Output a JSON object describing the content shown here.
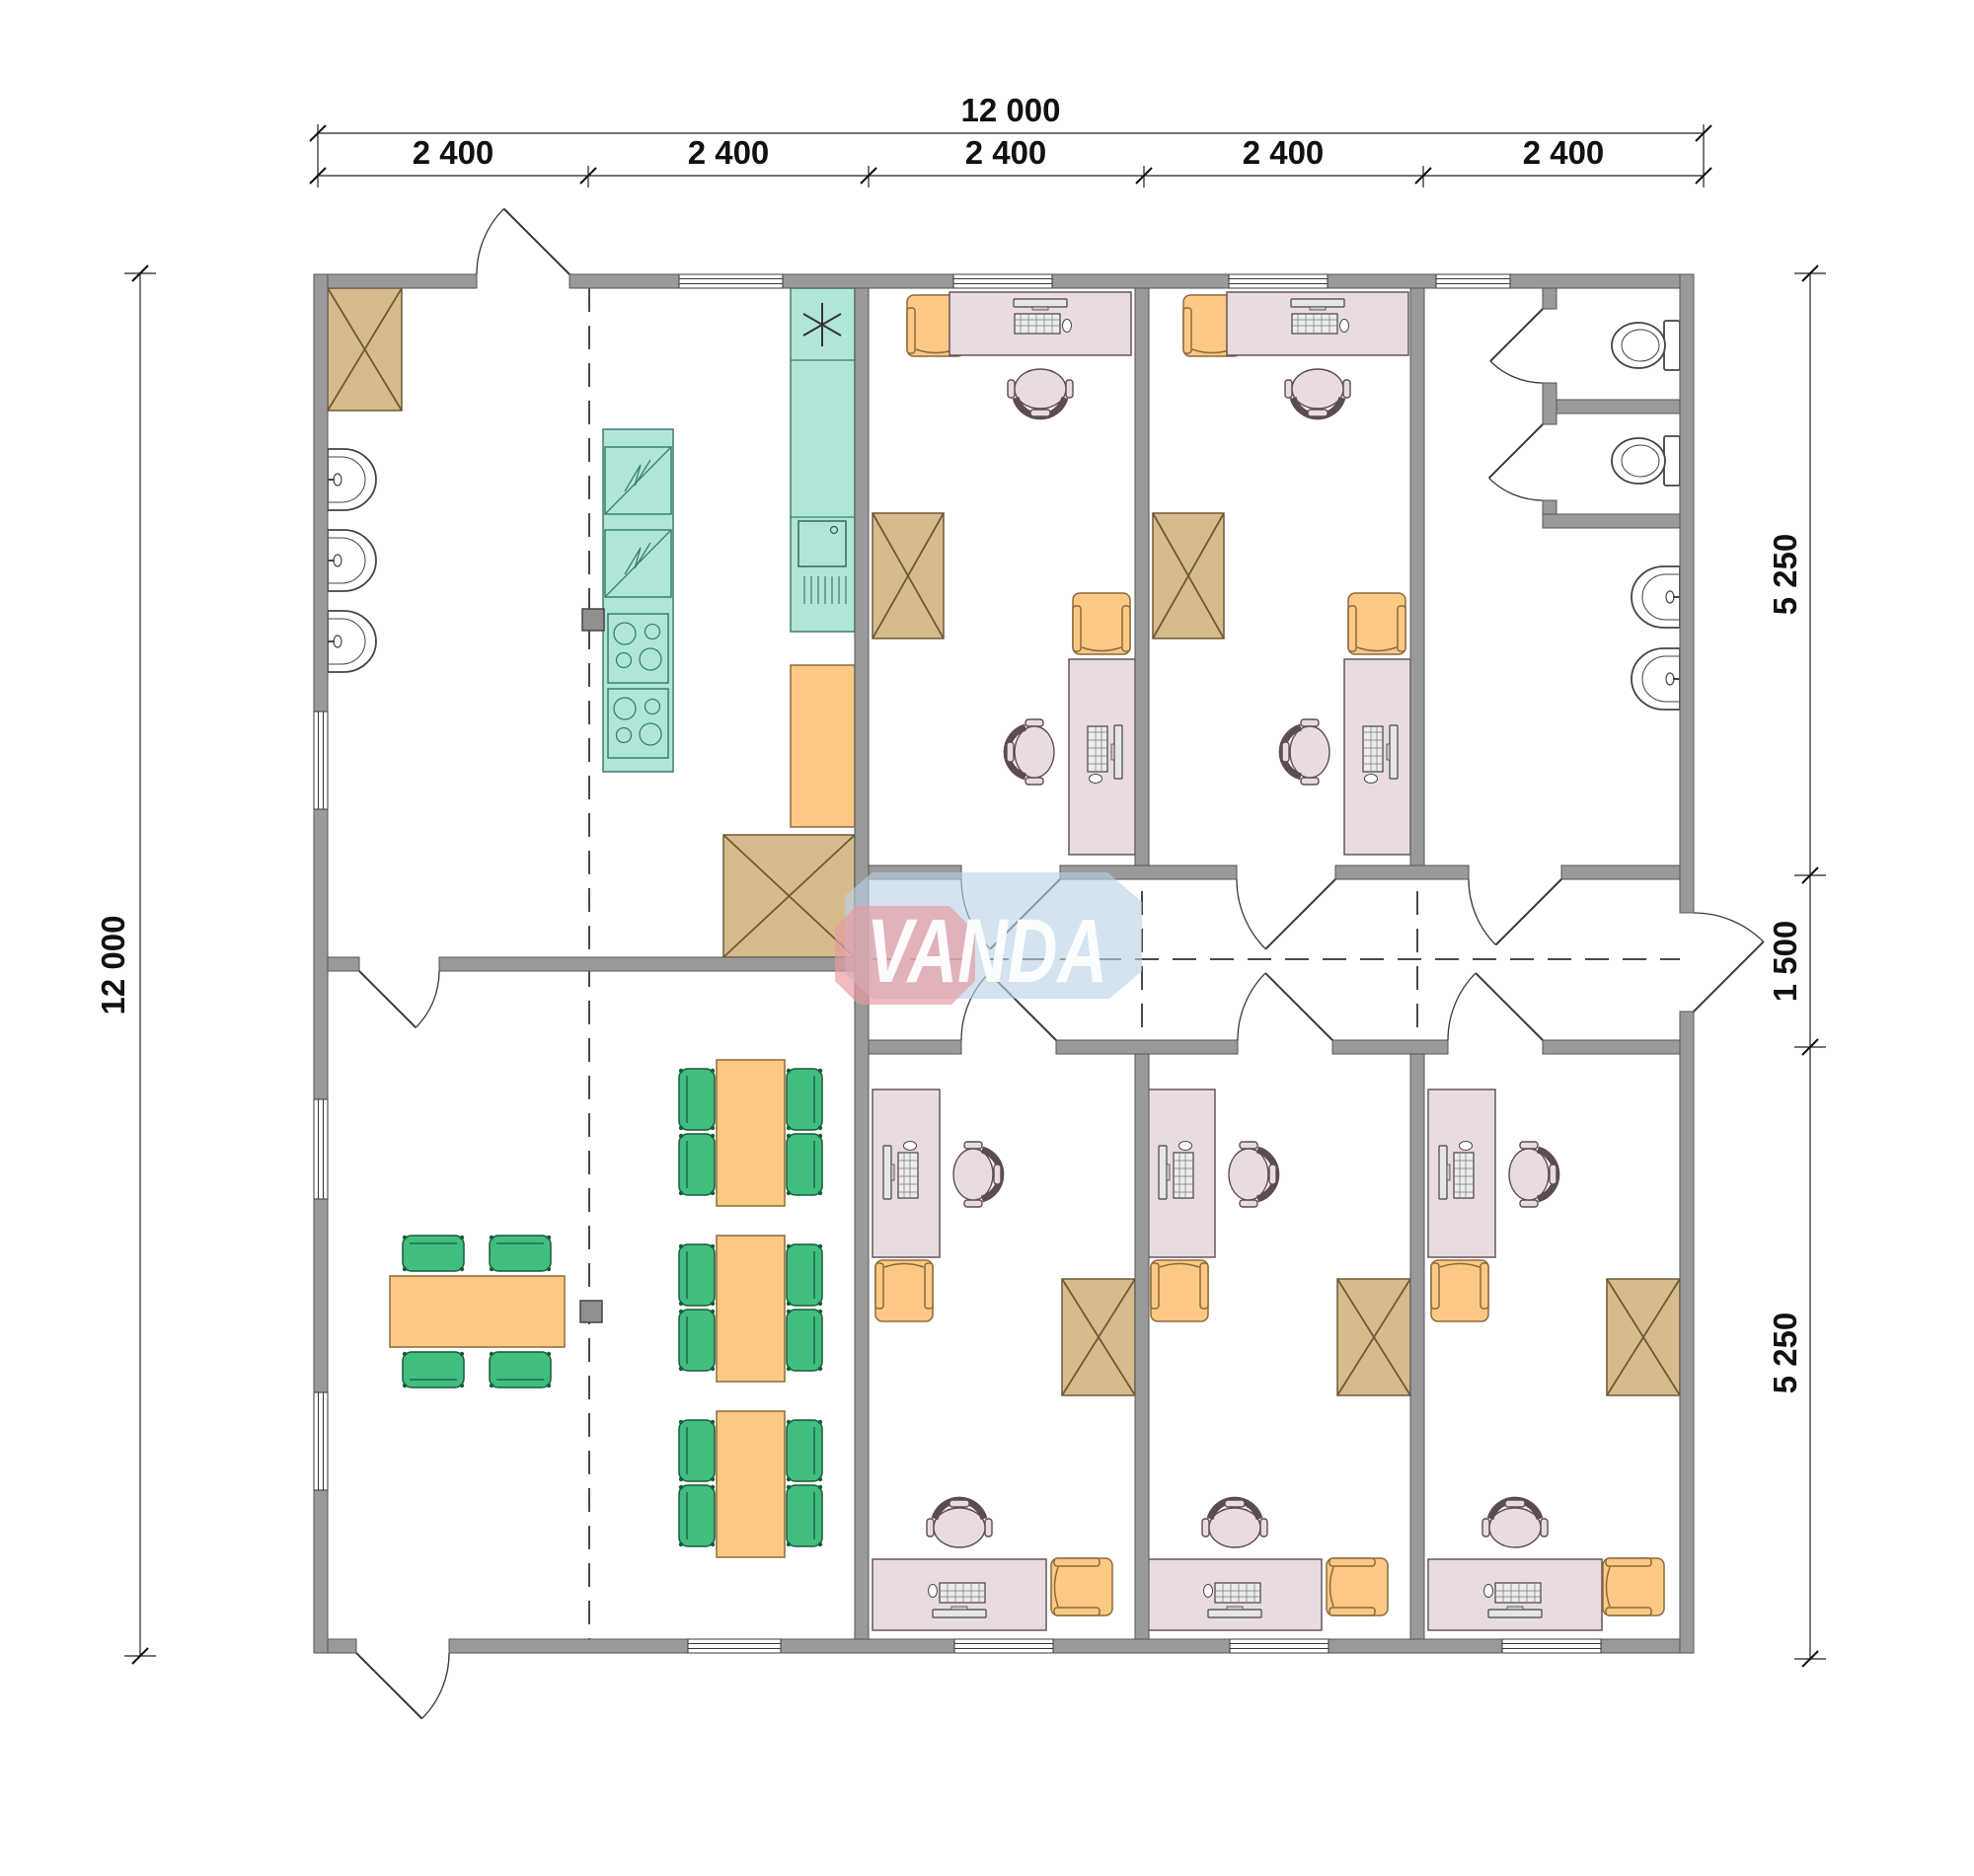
{
  "brand": {
    "name": "VANDA"
  },
  "dimensions": {
    "top_total": "12 000",
    "top_segments": [
      "2 400",
      "2 400",
      "2 400",
      "2 400",
      "2 400"
    ],
    "left_total": "12 000",
    "right_top": "5 250",
    "right_middle": "1 500",
    "right_bottom": "5 250"
  },
  "icons": {
    "kitchen_star": "✳",
    "wardrobe": "crossed-rectangle",
    "module_axis": "dashed-line"
  },
  "palette": {
    "wall": "#9a9a9a",
    "wall-edge": "#555555",
    "line": "#3a3a3a",
    "tan": "#d7bb8c",
    "tan-edge": "#6e5a33",
    "teal": "#b0e6da",
    "teal-edge": "#3d7d6d",
    "orange": "#fcc985",
    "orange-edge": "#8c6a3c",
    "green": "#41bd80",
    "green-edge": "#175c38",
    "pink": "#e9dbe0",
    "pink-edge": "#5c4c52",
    "dim-text": "#111111",
    "logo-blue": "#b8d4e6",
    "logo-red": "#e89ba0",
    "logo-text": "#ffffff"
  }
}
